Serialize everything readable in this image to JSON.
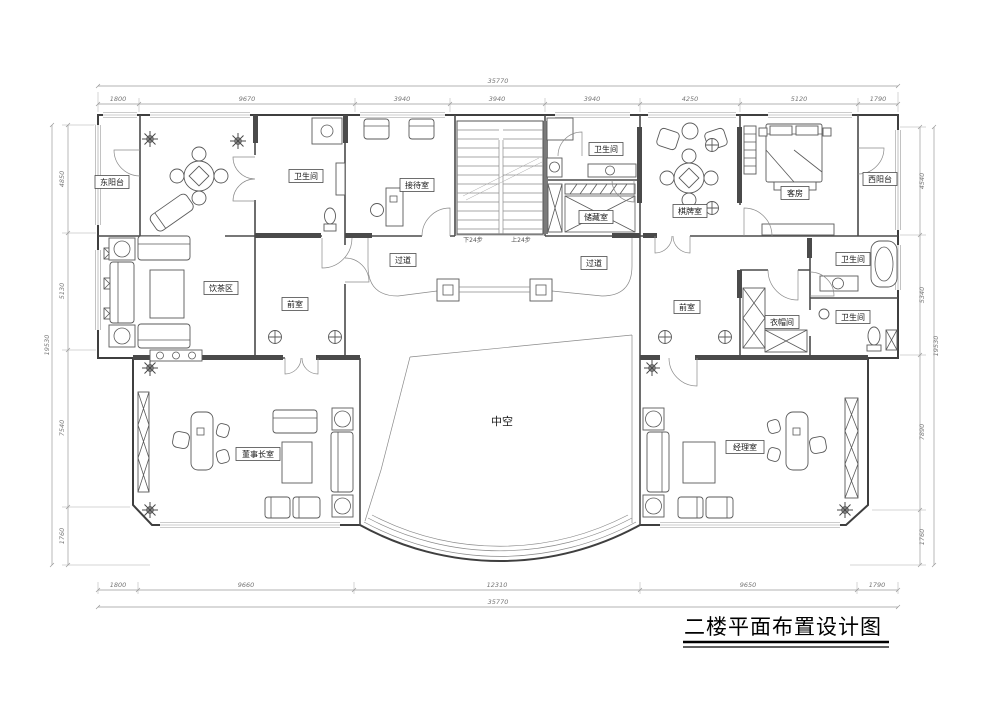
{
  "title": "二楼平面布置设计图",
  "drawing_type": "floor-plan",
  "rooms": {
    "east_balcony": "东阳台",
    "bath_left": "卫生间",
    "reception": "接待室",
    "bath_mid": "卫生间",
    "storage": "储藏室",
    "chess_room": "棋牌室",
    "guest_room": "客房",
    "west_balcony": "西阳台",
    "tea_area": "饮茶区",
    "ante_left": "前室",
    "corridor_left": "过道",
    "corridor_right": "过道",
    "ante_right": "前室",
    "cloakroom": "衣帽间",
    "bath_right_top": "卫生间",
    "bath_right_bottom": "卫生间",
    "atrium": "中空",
    "chairman_office": "董事长室",
    "manager_office": "经理室"
  },
  "stairs": {
    "down_label": "下24步",
    "up_label": "上24步"
  },
  "dimensions": {
    "top": {
      "total": "35770",
      "segments": [
        "1800",
        "9670",
        "3940",
        "3940",
        "3940",
        "4250",
        "5120",
        "1790"
      ]
    },
    "bottom": {
      "total": "35770",
      "segments": [
        "1800",
        "9660",
        "12310",
        "9650",
        "1790"
      ]
    },
    "left": {
      "total": "19530",
      "segments": [
        "4850",
        "5130",
        "7540",
        "1760"
      ]
    },
    "right": {
      "total": "19530",
      "segments": [
        "4540",
        "5340",
        "7890",
        "1760"
      ]
    }
  },
  "colors": {
    "wall": "#4a4a4a",
    "line": "#555555",
    "dimension": "#777777",
    "background": "#ffffff"
  }
}
